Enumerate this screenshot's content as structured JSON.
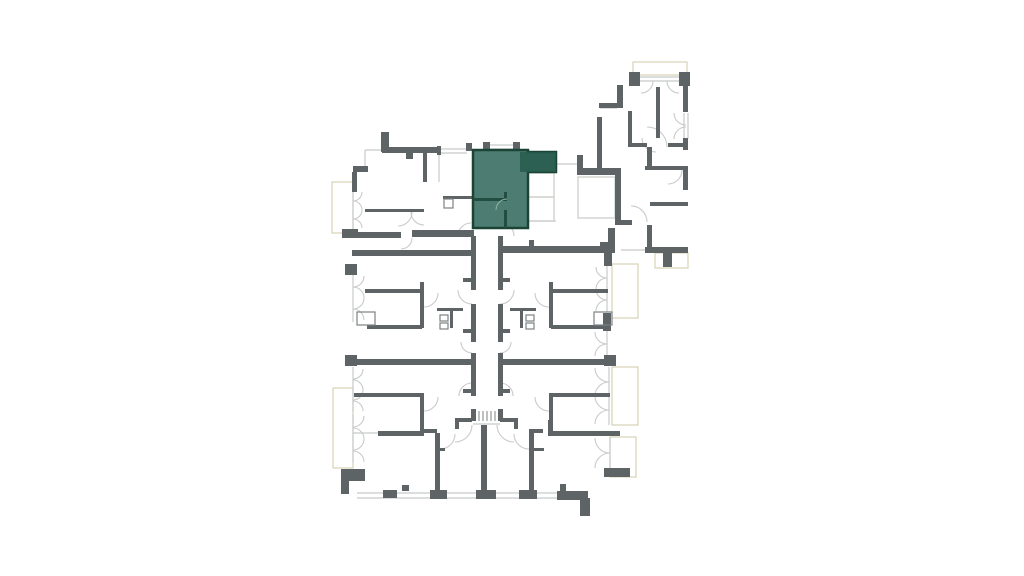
{
  "palette": {
    "background": "#ffffff",
    "wall": "#5E6366",
    "fixture": "#7C8183",
    "line": "#C8CBCA",
    "closet": "#C9CCC6",
    "balcony": "#D8D2B8",
    "unit_fill": "#3A6F63",
    "unit_border": "#1C4434",
    "unit_wall": "#224E41",
    "unit_overlay": "#275A4E"
  },
  "floorplan": {
    "canvas": {
      "w": 1024,
      "h": 576
    },
    "walls": [
      [
        381,
        132,
        8,
        20
      ],
      [
        382,
        147,
        56,
        6
      ],
      [
        406,
        153,
        7,
        6
      ],
      [
        437,
        146,
        4,
        9
      ],
      [
        466,
        143,
        6,
        8
      ],
      [
        483,
        142,
        7,
        9
      ],
      [
        513,
        142,
        7,
        9
      ],
      [
        353,
        166,
        15,
        6
      ],
      [
        352,
        172,
        5,
        20
      ],
      [
        342,
        229,
        16,
        9
      ],
      [
        357,
        232,
        44,
        6
      ],
      [
        412,
        230,
        62,
        7
      ],
      [
        423,
        150,
        4,
        32
      ],
      [
        365,
        209,
        59,
        3
      ],
      [
        443,
        196,
        31,
        3
      ],
      [
        577,
        155,
        6,
        14
      ],
      [
        577,
        168,
        44,
        7
      ],
      [
        615,
        175,
        6,
        50
      ],
      [
        615,
        220,
        17,
        5
      ],
      [
        647,
        225,
        5,
        24
      ],
      [
        645,
        247,
        43,
        6
      ],
      [
        663,
        253,
        9,
        14
      ],
      [
        600,
        242,
        15,
        11
      ],
      [
        608,
        228,
        7,
        14
      ],
      [
        500,
        246,
        101,
        7
      ],
      [
        529,
        240,
        5,
        6
      ],
      [
        352,
        250,
        121,
        6
      ],
      [
        345,
        264,
        12,
        11
      ],
      [
        345,
        355,
        12,
        11
      ],
      [
        341,
        469,
        24,
        12
      ],
      [
        341,
        481,
        8,
        13
      ],
      [
        352,
        359,
        119,
        6
      ],
      [
        500,
        359,
        112,
        6
      ],
      [
        604,
        355,
        12,
        11
      ],
      [
        378,
        431,
        46,
        5
      ],
      [
        548,
        431,
        72,
        5
      ],
      [
        548,
        420,
        5,
        13
      ],
      [
        604,
        468,
        26,
        9
      ],
      [
        557,
        491,
        31,
        9
      ],
      [
        580,
        498,
        10,
        18
      ],
      [
        383,
        490,
        14,
        8
      ],
      [
        430,
        490,
        17,
        9
      ],
      [
        476,
        490,
        20,
        9
      ],
      [
        519,
        490,
        18,
        9
      ],
      [
        402,
        485,
        7,
        6
      ],
      [
        560,
        484,
        6,
        8
      ],
      [
        471,
        236,
        5,
        54
      ],
      [
        471,
        304,
        5,
        38
      ],
      [
        471,
        353,
        5,
        43
      ],
      [
        471,
        409,
        5,
        12
      ],
      [
        498,
        236,
        5,
        54
      ],
      [
        498,
        304,
        5,
        38
      ],
      [
        498,
        353,
        5,
        43
      ],
      [
        498,
        409,
        5,
        12
      ],
      [
        455,
        418,
        17,
        4
      ],
      [
        500,
        418,
        18,
        4
      ],
      [
        455,
        421,
        4,
        8
      ],
      [
        514,
        421,
        4,
        8
      ],
      [
        481,
        425,
        6,
        73
      ],
      [
        435,
        433,
        5,
        62
      ],
      [
        529,
        433,
        5,
        62
      ],
      [
        424,
        429,
        13,
        4
      ],
      [
        529,
        429,
        14,
        4
      ],
      [
        435,
        448,
        10,
        3
      ],
      [
        534,
        448,
        10,
        3
      ],
      [
        365,
        289,
        59,
        4
      ],
      [
        420,
        282,
        4,
        8
      ],
      [
        420,
        293,
        4,
        35
      ],
      [
        367,
        325,
        55,
        4
      ],
      [
        463,
        278,
        10,
        4
      ],
      [
        463,
        329,
        10,
        4
      ],
      [
        437,
        308,
        26,
        3
      ],
      [
        450,
        311,
        3,
        17
      ],
      [
        549,
        289,
        59,
        4
      ],
      [
        549,
        282,
        4,
        8
      ],
      [
        549,
        293,
        4,
        35
      ],
      [
        551,
        325,
        55,
        4
      ],
      [
        500,
        278,
        10,
        4
      ],
      [
        500,
        329,
        10,
        4
      ],
      [
        510,
        308,
        26,
        3
      ],
      [
        520,
        311,
        3,
        17
      ],
      [
        420,
        395,
        4,
        40
      ],
      [
        354,
        393,
        70,
        4
      ],
      [
        463,
        389,
        10,
        4
      ],
      [
        549,
        395,
        4,
        40
      ],
      [
        549,
        393,
        61,
        4
      ],
      [
        500,
        389,
        10,
        4
      ],
      [
        603,
        313,
        8,
        18
      ],
      [
        604,
        253,
        8,
        13
      ],
      [
        629,
        72,
        11,
        14
      ],
      [
        679,
        72,
        11,
        14
      ],
      [
        617,
        85,
        6,
        23
      ],
      [
        599,
        103,
        19,
        5
      ],
      [
        597,
        117,
        5,
        53
      ],
      [
        683,
        85,
        5,
        27
      ],
      [
        683,
        138,
        5,
        12
      ],
      [
        656,
        87,
        4,
        51
      ],
      [
        628,
        111,
        4,
        36
      ],
      [
        630,
        143,
        17,
        4
      ],
      [
        668,
        143,
        20,
        4
      ],
      [
        647,
        147,
        5,
        20
      ],
      [
        645,
        166,
        43,
        4
      ],
      [
        683,
        170,
        5,
        20
      ],
      [
        650,
        202,
        38,
        4
      ]
    ],
    "fixtures": [
      [
        444,
        199,
        9,
        9
      ],
      [
        357,
        312,
        18,
        13
      ],
      [
        594,
        312,
        18,
        13
      ],
      [
        440,
        315,
        8,
        6
      ],
      [
        440,
        323,
        8,
        6
      ],
      [
        526,
        315,
        8,
        6
      ],
      [
        526,
        323,
        8,
        6
      ]
    ],
    "closets": [
      [
        528,
        173,
        26,
        24
      ],
      [
        528,
        197,
        26,
        24
      ],
      [
        578,
        177,
        37,
        41
      ]
    ],
    "balconies": [
      [
        633,
        62,
        54,
        13
      ],
      [
        332,
        182,
        21,
        51
      ],
      [
        333,
        388,
        20,
        80
      ],
      [
        612,
        264,
        26,
        54
      ],
      [
        612,
        367,
        26,
        58
      ],
      [
        610,
        437,
        26,
        40
      ],
      [
        655,
        253,
        33,
        15
      ]
    ],
    "window_lines": [
      [
        438,
        149,
        467,
        149
      ],
      [
        438,
        153,
        467,
        153
      ],
      [
        490,
        145,
        513,
        145
      ],
      [
        490,
        149,
        513,
        149
      ],
      [
        640,
        77,
        679,
        77
      ],
      [
        640,
        81,
        679,
        81
      ],
      [
        684,
        113,
        684,
        139
      ],
      [
        688,
        113,
        688,
        139
      ],
      [
        556,
        164,
        577,
        164
      ],
      [
        528,
        221,
        556,
        221
      ],
      [
        621,
        250,
        647,
        250
      ],
      [
        353,
        433,
        378,
        433
      ],
      [
        357,
        493,
        560,
        493
      ],
      [
        357,
        498,
        560,
        498
      ],
      [
        600,
        108,
        617,
        108
      ],
      [
        365,
        150,
        382,
        150
      ],
      [
        365,
        150,
        365,
        168
      ],
      [
        439,
        150,
        439,
        182
      ],
      [
        610,
        437,
        610,
        468
      ],
      [
        607,
        266,
        607,
        312
      ],
      [
        607,
        331,
        607,
        356
      ],
      [
        609,
        367,
        609,
        425
      ],
      [
        353,
        190,
        353,
        230
      ],
      [
        353,
        274,
        353,
        322
      ],
      [
        353,
        367,
        353,
        412
      ],
      [
        353,
        414,
        353,
        463
      ],
      [
        473,
        424,
        500,
        424
      ]
    ],
    "stair_lines": [
      [
        475,
        411,
        475,
        421
      ],
      [
        479,
        411,
        479,
        421
      ],
      [
        483,
        411,
        483,
        421
      ],
      [
        487,
        411,
        487,
        421
      ],
      [
        491,
        411,
        491,
        421
      ],
      [
        495,
        411,
        495,
        421
      ],
      [
        499,
        411,
        499,
        421
      ]
    ],
    "door_arcs": [
      [
        353,
        192,
        9,
        0,
        90
      ],
      [
        353,
        210,
        9,
        270,
        360
      ],
      [
        353,
        210,
        9,
        0,
        90
      ],
      [
        353,
        228,
        9,
        270,
        360
      ],
      [
        353,
        276,
        11,
        0,
        90
      ],
      [
        353,
        298,
        11,
        270,
        360
      ],
      [
        353,
        298,
        11,
        0,
        90
      ],
      [
        353,
        320,
        11,
        270,
        360
      ],
      [
        353,
        369,
        10,
        0,
        90
      ],
      [
        353,
        390,
        10,
        270,
        360
      ],
      [
        353,
        390,
        10,
        0,
        90
      ],
      [
        353,
        411,
        10,
        270,
        360
      ],
      [
        353,
        416,
        11,
        0,
        90
      ],
      [
        353,
        439,
        11,
        270,
        360
      ],
      [
        353,
        439,
        11,
        0,
        90
      ],
      [
        353,
        462,
        11,
        270,
        360
      ],
      [
        607,
        267,
        11,
        90,
        180
      ],
      [
        607,
        289,
        11,
        180,
        270
      ],
      [
        607,
        289,
        11,
        90,
        180
      ],
      [
        607,
        311,
        11,
        180,
        270
      ],
      [
        607,
        332,
        12,
        90,
        180
      ],
      [
        607,
        356,
        12,
        180,
        270
      ],
      [
        609,
        368,
        14,
        90,
        180
      ],
      [
        609,
        396,
        14,
        180,
        270
      ],
      [
        609,
        396,
        14,
        90,
        180
      ],
      [
        609,
        424,
        14,
        180,
        270
      ],
      [
        610,
        438,
        15,
        90,
        180
      ],
      [
        610,
        468,
        15,
        180,
        270
      ],
      [
        641,
        81,
        12,
        0,
        90
      ],
      [
        679,
        81,
        12,
        90,
        180
      ],
      [
        686,
        113,
        12,
        90,
        180
      ],
      [
        686,
        139,
        12,
        180,
        270
      ],
      [
        398,
        212,
        14,
        0,
        90
      ],
      [
        424,
        212,
        13,
        90,
        180
      ],
      [
        401,
        238,
        11,
        0,
        90
      ],
      [
        471,
        236,
        13,
        180,
        270
      ],
      [
        501,
        236,
        13,
        270,
        360
      ],
      [
        472,
        290,
        14,
        90,
        180
      ],
      [
        500,
        290,
        14,
        0,
        90
      ],
      [
        472,
        342,
        11,
        90,
        180
      ],
      [
        500,
        342,
        11,
        0,
        90
      ],
      [
        472,
        396,
        13,
        180,
        270
      ],
      [
        500,
        396,
        13,
        270,
        360
      ],
      [
        455,
        425,
        17,
        0,
        90
      ],
      [
        514,
        425,
        17,
        90,
        180
      ],
      [
        440,
        434,
        15,
        0,
        90
      ],
      [
        529,
        434,
        15,
        90,
        180
      ],
      [
        424,
        293,
        14,
        0,
        90
      ],
      [
        549,
        293,
        14,
        90,
        180
      ],
      [
        424,
        397,
        14,
        0,
        90
      ],
      [
        549,
        397,
        14,
        90,
        180
      ],
      [
        631,
        222,
        16,
        270,
        360
      ],
      [
        656,
        138,
        14,
        90,
        180
      ],
      [
        647,
        147,
        20,
        270,
        360
      ],
      [
        668,
        170,
        14,
        0,
        90
      ]
    ],
    "unit": {
      "id": "highlighted-unit",
      "polygon": [
        [
          473,
          150
        ],
        [
          528,
          150
        ],
        [
          528,
          152
        ],
        [
          556,
          152
        ],
        [
          556,
          172
        ],
        [
          528,
          172
        ],
        [
          528,
          228
        ],
        [
          473,
          228
        ]
      ],
      "overlay": [
        520,
        152,
        36,
        20
      ],
      "walls": [
        [
          473,
          198,
          34,
          3
        ],
        [
          504,
          192,
          3,
          9
        ],
        [
          504,
          210,
          3,
          18
        ]
      ],
      "arcs": [
        [
          507,
          210,
          11,
          180,
          270
        ]
      ]
    }
  }
}
